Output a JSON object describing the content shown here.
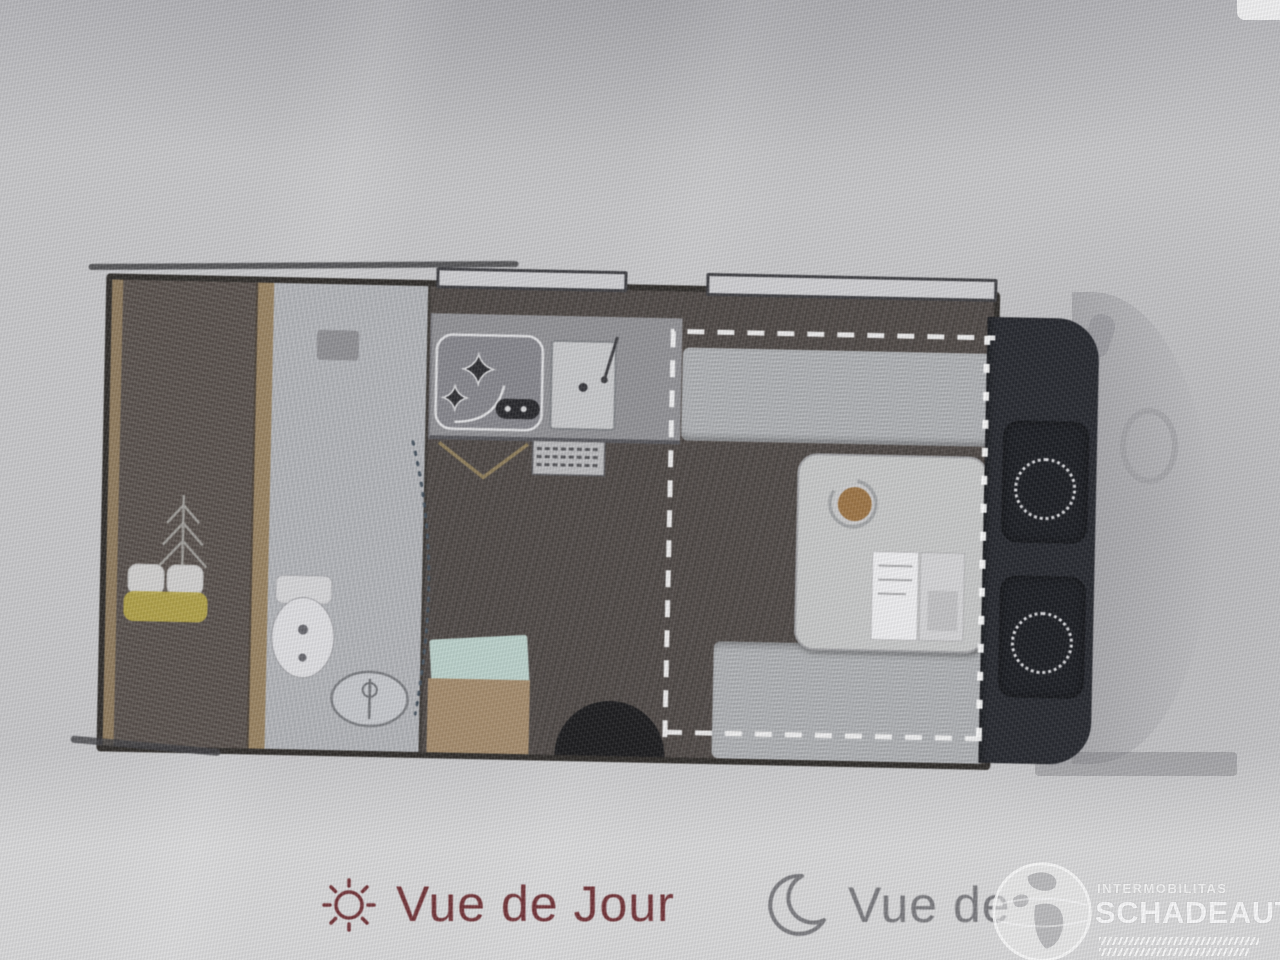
{
  "legend": {
    "day": {
      "label": "Vue de Jour",
      "icon": "sun-icon"
    },
    "night": {
      "label": "Vue de",
      "icon": "moon-icon"
    }
  },
  "watermark": {
    "line1": "INTERMOBILITAS",
    "line2": "SCHADEAUTOS.NL",
    "icon": "globe-icon"
  },
  "floorplan": {
    "type": "camper-van-layout-top-view",
    "areas": [
      "rear-bed",
      "bathroom",
      "kitchen",
      "dinette",
      "driver-cab"
    ],
    "features": [
      "double-bed-with-pillows",
      "toilet",
      "wash-basin",
      "shower-door-arc",
      "two-burner-hob",
      "kitchen-sink",
      "vent-grille",
      "entry-mats",
      "entry-step",
      "top-bench-sofa",
      "dinette-table",
      "side-bench",
      "drop-down-bed-dashed-outline",
      "swivel-driver-seat",
      "swivel-passenger-seat",
      "windows",
      "faded-vehicle-front"
    ]
  },
  "colors": {
    "bg-top": "#b4b4b8",
    "bg-mid": "#c6c6c8",
    "bg-bottom": "#d7d7d8",
    "wall": "#2e2b28",
    "wood": "#96805f",
    "bed": "#574f4a",
    "bath": "#b2b4b8",
    "counter": "#8f8f93",
    "floor": "#4e4845",
    "bench": "#aeb0b3",
    "table": "#c5c6c6",
    "cab": "#24262c",
    "seat": "#191b20",
    "day-accent": "#6e3034",
    "night-accent": "#77777b",
    "mat-teal": "#b9cfc9",
    "mat-tan": "#a2896a",
    "blanket-yellow": "#b2a247",
    "table-dot": "#9a7243",
    "white-line": "#f2f2f2"
  }
}
